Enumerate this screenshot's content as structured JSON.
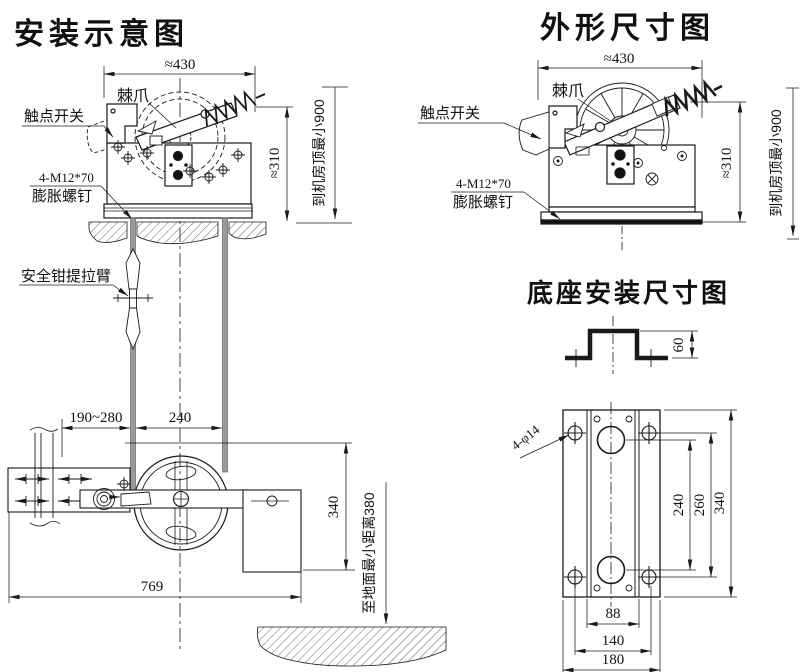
{
  "install_view": {
    "title": "安装示意图",
    "labels": {
      "pawl": "棘爪",
      "contact_switch": "触点开关",
      "bolt_spec": "4-M12*70",
      "expansion_bolt": "膨胀螺钉",
      "safety_arm": "安全钳提拉臂"
    },
    "dims": {
      "width": "≈430",
      "height": "≈310",
      "to_ceiling": "到机房顶最小900",
      "rail_range": "190~280",
      "rope_span": "240",
      "tail_height": "340",
      "base_width": "769",
      "to_floor": "至地面最小距离380"
    }
  },
  "outline_view": {
    "title": "外形尺寸图",
    "labels": {
      "pawl": "棘爪",
      "contact_switch": "触点开关",
      "bolt_spec": "4-M12*70",
      "expansion_bolt": "膨胀螺钉"
    },
    "dims": {
      "width": "≈430",
      "height": "≈310",
      "to_ceiling": "到机房顶最小900"
    }
  },
  "base_view": {
    "title": "底座安装尺寸图",
    "dims": {
      "hat_height": "60",
      "hole_spec": "4-φ14",
      "holes_span": "240",
      "bolts_span": "260",
      "plate_height": "340",
      "inner_width": "88",
      "bolt_width": "140",
      "plate_width": "180"
    }
  }
}
